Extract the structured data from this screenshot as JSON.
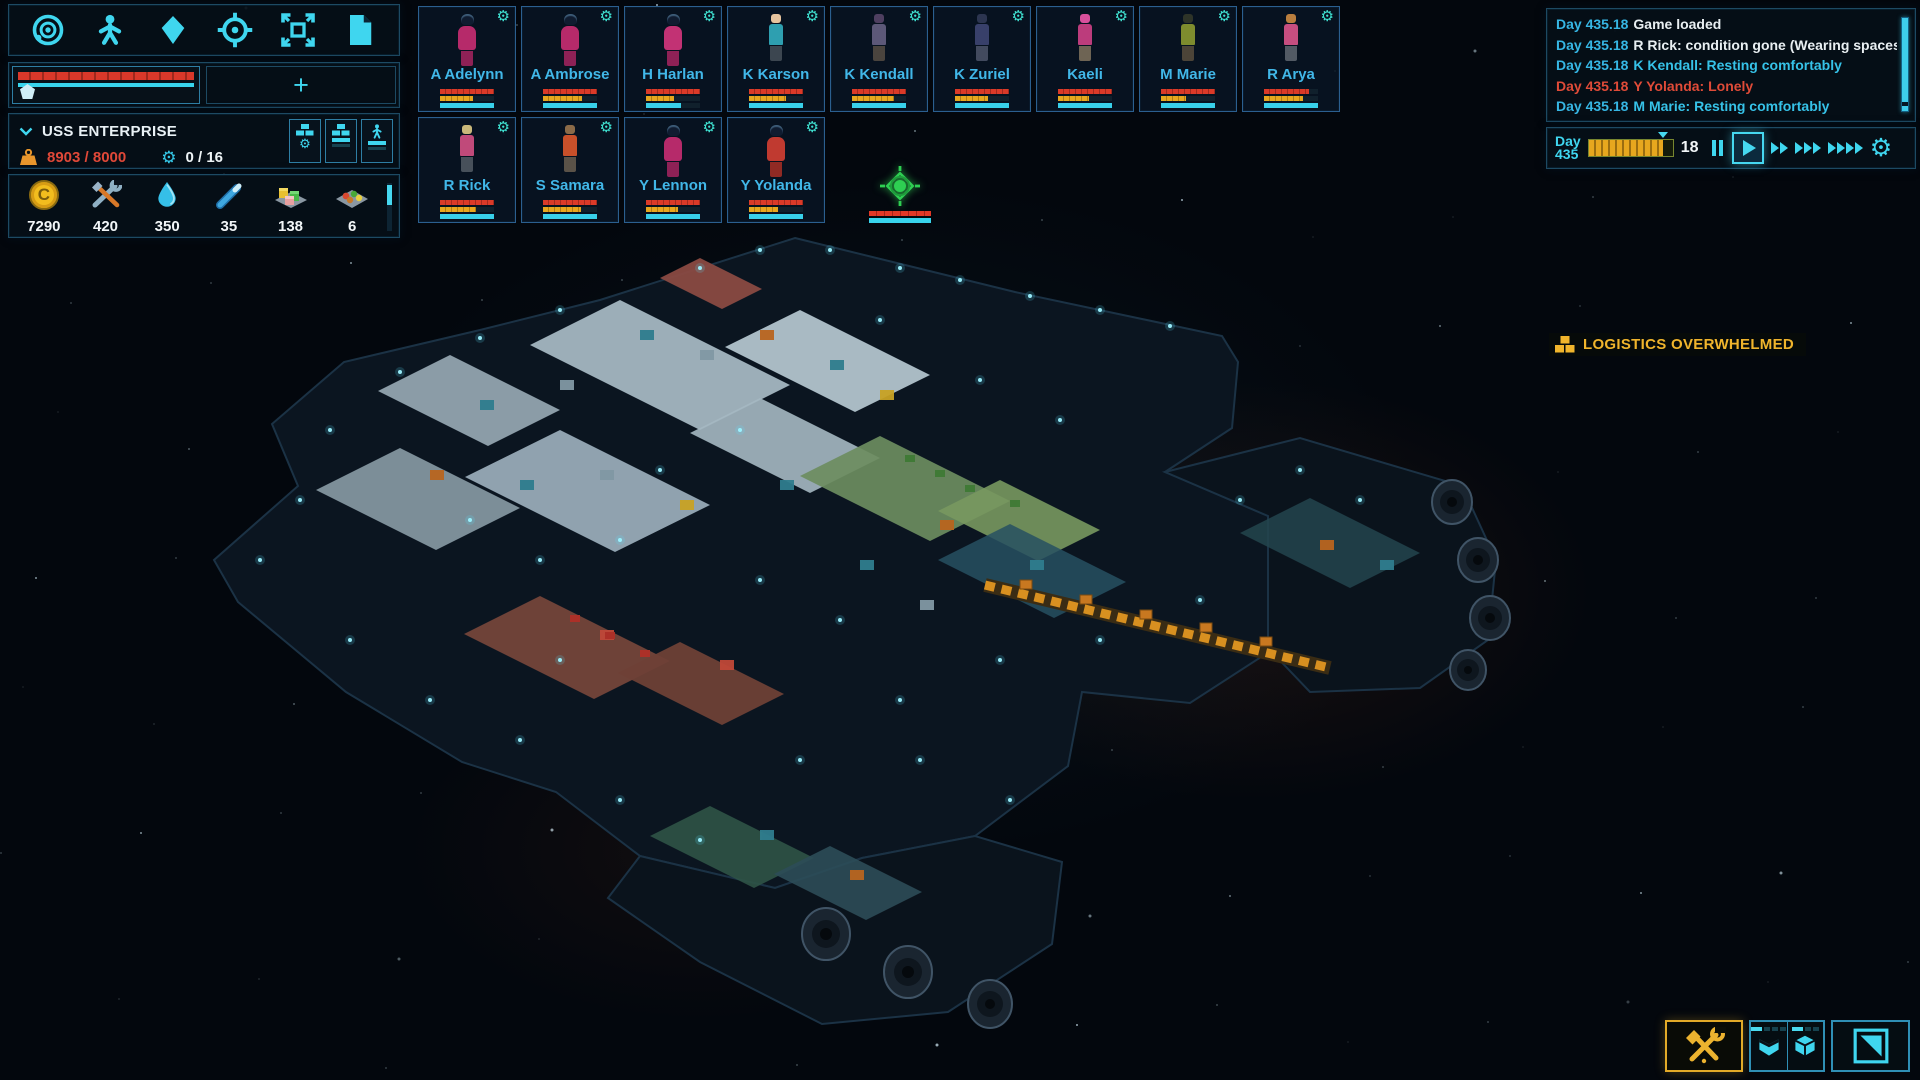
{
  "left_panel": {
    "toolbar_icons": [
      "system-view-icon",
      "crew-icon",
      "resource-icon",
      "target-icon",
      "expand-icon",
      "report-icon"
    ],
    "ship_bar": {
      "hull_color": "#d9382a",
      "shield_color": "#38d4ec",
      "add_button_label": "+"
    },
    "ship_info": {
      "name": "USS ENTERPRISE",
      "mass": "8903 / 8000",
      "crew_slots": "0 / 16"
    },
    "resources": [
      {
        "icon": "credits",
        "value": "7290"
      },
      {
        "icon": "tools",
        "value": "420"
      },
      {
        "icon": "water",
        "value": "350"
      },
      {
        "icon": "energy-rod",
        "value": "35"
      },
      {
        "icon": "blocks",
        "value": "138"
      },
      {
        "icon": "food",
        "value": "6"
      }
    ]
  },
  "crew": {
    "members": [
      {
        "name": "A Adelynn",
        "suit": true,
        "hair": "#101c30",
        "top": "#b62a6a",
        "bottom": "#8e2156",
        "red": 100,
        "yellow": 62,
        "cyan": 100
      },
      {
        "name": "A Ambrose",
        "suit": true,
        "hair": "#101c30",
        "top": "#b62a6a",
        "bottom": "#8e2156",
        "red": 100,
        "yellow": 72,
        "cyan": 100
      },
      {
        "name": "H Harlan",
        "suit": true,
        "hair": "#101c30",
        "top": "#c23274",
        "bottom": "#8e2156",
        "red": 100,
        "yellow": 52,
        "cyan": 64
      },
      {
        "name": "K Karson",
        "suit": false,
        "hair": "#e6c49e",
        "top": "#2e9fb0",
        "bottom": "#3c4650",
        "red": 100,
        "yellow": 68,
        "cyan": 100
      },
      {
        "name": "K Kendall",
        "suit": false,
        "hair": "#4e3f60",
        "top": "#5c5878",
        "bottom": "#4a443e",
        "red": 100,
        "yellow": 78,
        "cyan": 100
      },
      {
        "name": "K Zuriel",
        "suit": false,
        "hair": "#2c3550",
        "top": "#38406a",
        "bottom": "#424a5e",
        "red": 100,
        "yellow": 62,
        "cyan": 100
      },
      {
        "name": "Kaeli",
        "suit": false,
        "hair": "#d8509c",
        "top": "#bc3c7c",
        "bottom": "#6e6454",
        "red": 100,
        "yellow": 58,
        "cyan": 100
      },
      {
        "name": "M Marie",
        "suit": false,
        "hair": "#2e3428",
        "top": "#7e8c2e",
        "bottom": "#4c4438",
        "red": 100,
        "yellow": 46,
        "cyan": 100
      },
      {
        "name": "R Arya",
        "suit": false,
        "hair": "#b97e3e",
        "top": "#c64e80",
        "bottom": "#525a64",
        "red": 84,
        "yellow": 72,
        "cyan": 100
      },
      {
        "name": "R Rick",
        "suit": false,
        "hair": "#c9b87a",
        "top": "#c04a7a",
        "bottom": "#47505a",
        "red": 100,
        "yellow": 66,
        "cyan": 100
      },
      {
        "name": "S Samara",
        "suit": false,
        "hair": "#8a6a48",
        "top": "#c8502a",
        "bottom": "#5a5248",
        "red": 100,
        "yellow": 70,
        "cyan": 100
      },
      {
        "name": "Y Lennon",
        "suit": true,
        "hair": "#101c30",
        "top": "#b62a6a",
        "bottom": "#8e2156",
        "red": 100,
        "yellow": 60,
        "cyan": 100
      },
      {
        "name": "Y Yolanda",
        "suit": true,
        "hair": "#101c30",
        "top": "#c03a30",
        "bottom": "#902a24",
        "red": 100,
        "yellow": 54,
        "cyan": 100
      }
    ]
  },
  "event_log": {
    "lines": [
      {
        "day": "Day 435.18",
        "message": "Game loaded",
        "tone": "white"
      },
      {
        "day": "Day 435.18",
        "message": "R Rick: condition gone (Wearing spacesuit)",
        "tone": "white"
      },
      {
        "day": "Day 435.18",
        "message": "K Kendall: Resting comfortably",
        "tone": "cyan"
      },
      {
        "day": "Day 435.18",
        "message": "Y Yolanda: Lonely",
        "tone": "red"
      },
      {
        "day": "Day 435.18",
        "message": "M Marie: Resting comfortably",
        "tone": "cyan"
      }
    ]
  },
  "time": {
    "day_label": "Day",
    "day_value": "435",
    "counter": "18",
    "progress_pct": 88
  },
  "alert": {
    "label": "LOGISTICS OVERWHELMED",
    "color": "#f0b42c"
  },
  "ship_marker": {
    "color": "#2ecf52"
  },
  "bottom_bar": {
    "buttons": [
      "build-tool",
      "storage-open",
      "storage-closed",
      "view-toggle"
    ]
  }
}
